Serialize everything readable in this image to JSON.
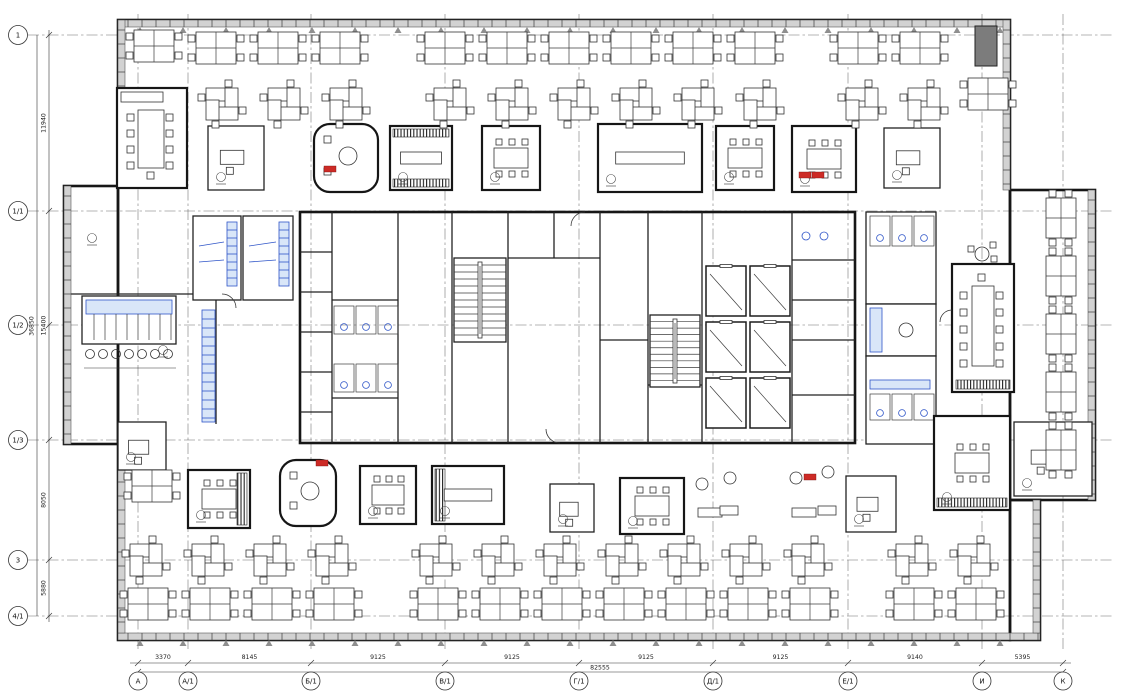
{
  "colors": {
    "line": "#1d1d1d",
    "wall": "#161616",
    "window_fill": "#d2d2d2",
    "grid": "#6a6a6a",
    "accent_blue": "#2f55c8",
    "accent_blue_fill": "#d9e6f8",
    "accent_red": "#cd2b26",
    "shaft_gray": "#7c7c7c",
    "paper": "#ffffff"
  },
  "plan": {
    "axes": {
      "left": [
        {
          "label": "1",
          "y": 35
        },
        {
          "label": "1/1",
          "y": 211
        },
        {
          "label": "1/2",
          "y": 325
        },
        {
          "label": "1/3",
          "y": 440
        },
        {
          "label": "3",
          "y": 560
        },
        {
          "label": "4/1",
          "y": 616
        }
      ],
      "bottom": [
        {
          "label": "А",
          "x": 138
        },
        {
          "label": "А/1",
          "x": 188
        },
        {
          "label": "Б/1",
          "x": 311
        },
        {
          "label": "В/1",
          "x": 445
        },
        {
          "label": "Г/1",
          "x": 579
        },
        {
          "label": "Д/1",
          "x": 713
        },
        {
          "label": "Е/1",
          "x": 848
        },
        {
          "label": "И",
          "x": 982
        },
        {
          "label": "К",
          "x": 1063
        }
      ]
    },
    "dims": {
      "bottom": {
        "segments": [
          {
            "value": "3370"
          },
          {
            "value": "8145"
          },
          {
            "value": "9125"
          },
          {
            "value": "9125"
          },
          {
            "value": "9125"
          },
          {
            "value": "9125"
          },
          {
            "value": "9140"
          },
          {
            "value": "5395"
          }
        ],
        "overall": "82555"
      },
      "left": {
        "segments": [
          {
            "value": "11940",
            "a": 0,
            "b": 1
          },
          {
            "value": "15400",
            "a": 1,
            "b": 3
          },
          {
            "value": "8050",
            "a": 3,
            "b": 4
          },
          {
            "value": "5880",
            "a": 4,
            "b": 5
          }
        ],
        "overall": "36850"
      }
    },
    "outlines": [
      {
        "x": 118,
        "y": 20,
        "w": 892,
        "h": 620
      },
      {
        "x": 1010,
        "y": 190,
        "w": 85,
        "h": 310
      },
      {
        "x": 64,
        "y": 186,
        "w": 54,
        "h": 258
      },
      {
        "x": 1010,
        "y": 500,
        "w": 30,
        "h": 140
      }
    ],
    "inner_walls": [
      [
        64,
        294,
        216,
        294
      ],
      [
        216,
        294,
        216,
        424
      ]
    ],
    "windows": [
      {
        "x": 118,
        "y": 20,
        "w": 892,
        "h": 7,
        "dir": "h"
      },
      {
        "x": 118,
        "y": 633,
        "w": 922,
        "h": 7,
        "dir": "h"
      },
      {
        "x": 64,
        "y": 186,
        "w": 7,
        "h": 258,
        "dir": "v"
      },
      {
        "x": 118,
        "y": 20,
        "w": 7,
        "h": 68,
        "dir": "v"
      },
      {
        "x": 118,
        "y": 444,
        "w": 7,
        "h": 189,
        "dir": "v"
      },
      {
        "x": 1003,
        "y": 20,
        "w": 7,
        "h": 170,
        "dir": "v"
      },
      {
        "x": 1088,
        "y": 190,
        "w": 7,
        "h": 310,
        "dir": "v"
      },
      {
        "x": 1033,
        "y": 500,
        "w": 7,
        "h": 133,
        "dir": "v"
      }
    ],
    "core": {
      "x": 300,
      "y": 212,
      "w": 555,
      "h": 231,
      "vwalls": [
        332,
        398,
        452,
        508,
        600,
        648,
        702,
        792
      ],
      "vwalls_part": [
        [
          554,
          212,
          258
        ]
      ],
      "hwalls": [
        [
          508,
          600,
          258
        ],
        [
          332,
          398,
          300
        ],
        [
          332,
          398,
          398
        ],
        [
          600,
          648,
          340
        ],
        [
          648,
          702,
          385
        ],
        [
          792,
          855,
          260
        ],
        [
          300,
          332,
          252
        ],
        [
          300,
          332,
          292
        ],
        [
          300,
          332,
          332
        ],
        [
          300,
          332,
          372
        ],
        [
          300,
          332,
          412
        ],
        [
          792,
          855,
          300
        ],
        [
          792,
          855,
          340
        ],
        [
          792,
          855,
          395
        ]
      ],
      "stairs": [
        {
          "x": 454,
          "y": 258,
          "w": 52,
          "h": 84,
          "n": 11
        },
        {
          "x": 650,
          "y": 315,
          "w": 50,
          "h": 72,
          "n": 10
        }
      ],
      "elevators": [
        [
          706,
          266
        ],
        [
          750,
          266
        ],
        [
          706,
          322
        ],
        [
          750,
          322
        ],
        [
          706,
          378
        ],
        [
          750,
          378
        ]
      ],
      "stalls": [
        [
          334,
          306
        ],
        [
          356,
          306
        ],
        [
          378,
          306
        ],
        [
          334,
          364
        ],
        [
          356,
          364
        ],
        [
          378,
          364
        ]
      ],
      "wc_circles": [
        [
          806,
          236
        ],
        [
          824,
          236
        ]
      ]
    },
    "east": {
      "wc_top": {
        "x": 866,
        "y": 212,
        "w": 70,
        "h": 92
      },
      "kitchenette": {
        "x": 866,
        "y": 304,
        "w": 70,
        "h": 52
      },
      "wc_bot": {
        "x": 866,
        "y": 356,
        "w": 70,
        "h": 88
      },
      "stalls_top": [
        [
          870,
          216
        ],
        [
          892,
          216
        ],
        [
          914,
          216
        ]
      ],
      "stalls_bot": [
        [
          870,
          394
        ],
        [
          892,
          394
        ],
        [
          914,
          394
        ]
      ],
      "counter": {
        "x": 870,
        "y": 380,
        "w": 60,
        "h": 9
      },
      "counter2": {
        "x": 870,
        "y": 308,
        "w": 12,
        "h": 44
      },
      "basin": [
        906,
        330
      ]
    },
    "left_zone": {
      "kitchen": {
        "x": 82,
        "y": 296,
        "w": 94,
        "h": 48
      },
      "stools": [
        [
          90,
          354
        ],
        [
          103,
          354
        ],
        [
          116,
          354
        ],
        [
          129,
          354
        ],
        [
          142,
          354
        ],
        [
          155,
          354
        ],
        [
          168,
          354
        ]
      ],
      "lockers": {
        "x": 202,
        "y": 310,
        "w": 13,
        "h": 112
      },
      "it_rooms": [
        {
          "x": 193,
          "y": 216,
          "w": 48,
          "h": 84,
          "rack": {
            "x": 227,
            "y": 222,
            "w": 10,
            "h": 64
          }
        },
        {
          "x": 243,
          "y": 216,
          "w": 50,
          "h": 84,
          "rack": {
            "x": 279,
            "y": 222,
            "w": 10,
            "h": 64
          }
        }
      ],
      "conf": {
        "x": 117,
        "y": 88,
        "w": 70,
        "h": 100
      }
    },
    "right_zone": {
      "conf": {
        "x": 952,
        "y": 264,
        "w": 62,
        "h": 128
      },
      "round_table": [
        982,
        254
      ],
      "shaft": {
        "x": 975,
        "y": 26,
        "w": 22,
        "h": 40
      }
    },
    "rooms": [
      {
        "kind": "office",
        "x": 208,
        "y": 126,
        "w": 56,
        "h": 64
      },
      {
        "kind": "pod",
        "x": 314,
        "y": 124,
        "w": 64,
        "h": 68
      },
      {
        "kind": "booth",
        "x": 390,
        "y": 126,
        "w": 62,
        "h": 64,
        "hatch": "tb"
      },
      {
        "kind": "meeting",
        "x": 482,
        "y": 126,
        "w": 58,
        "h": 64
      },
      {
        "kind": "booth",
        "x": 598,
        "y": 124,
        "w": 104,
        "h": 68,
        "hatch": "none"
      },
      {
        "kind": "meeting",
        "x": 716,
        "y": 126,
        "w": 58,
        "h": 64
      },
      {
        "kind": "meeting",
        "x": 792,
        "y": 126,
        "w": 64,
        "h": 66
      },
      {
        "kind": "office",
        "x": 884,
        "y": 128,
        "w": 56,
        "h": 60
      },
      {
        "kind": "pod",
        "x": 280,
        "y": 460,
        "w": 56,
        "h": 66
      },
      {
        "kind": "meeting",
        "x": 360,
        "y": 466,
        "w": 56,
        "h": 58
      },
      {
        "kind": "booth",
        "x": 432,
        "y": 466,
        "w": 72,
        "h": 58,
        "hatch": "left"
      },
      {
        "kind": "office",
        "x": 550,
        "y": 484,
        "w": 44,
        "h": 48
      },
      {
        "kind": "meeting",
        "x": 620,
        "y": 478,
        "w": 64,
        "h": 56
      },
      {
        "kind": "lounge",
        "x": 690,
        "y": 468,
        "w": 56,
        "h": 56
      },
      {
        "kind": "lounge",
        "x": 784,
        "y": 462,
        "w": 60,
        "h": 62
      },
      {
        "kind": "office",
        "x": 846,
        "y": 476,
        "w": 50,
        "h": 56
      },
      {
        "kind": "meeting",
        "x": 934,
        "y": 416,
        "w": 76,
        "h": 94,
        "hatch": "bottom"
      },
      {
        "kind": "office",
        "x": 1014,
        "y": 422,
        "w": 78,
        "h": 74
      },
      {
        "kind": "office",
        "x": 118,
        "y": 422,
        "w": 48,
        "h": 48
      },
      {
        "kind": "meeting",
        "x": 188,
        "y": 470,
        "w": 62,
        "h": 58,
        "hatch": "right"
      }
    ],
    "desks": {
      "quad": [
        [
          196,
          32
        ],
        [
          258,
          32
        ],
        [
          320,
          32
        ],
        [
          425,
          32
        ],
        [
          487,
          32
        ],
        [
          549,
          32
        ],
        [
          611,
          32
        ],
        [
          673,
          32
        ],
        [
          735,
          32
        ],
        [
          838,
          32
        ],
        [
          900,
          32
        ],
        [
          134,
          30
        ],
        [
          968,
          78
        ],
        [
          128,
          588
        ],
        [
          190,
          588
        ],
        [
          252,
          588
        ],
        [
          314,
          588
        ],
        [
          418,
          588
        ],
        [
          480,
          588
        ],
        [
          542,
          588
        ],
        [
          604,
          588
        ],
        [
          666,
          588
        ],
        [
          728,
          588
        ],
        [
          790,
          588
        ],
        [
          894,
          588
        ],
        [
          956,
          588
        ],
        [
          132,
          470
        ]
      ],
      "pin": [
        [
          222,
          104
        ],
        [
          284,
          104
        ],
        [
          346,
          104
        ],
        [
          450,
          104
        ],
        [
          512,
          104
        ],
        [
          574,
          104
        ],
        [
          636,
          104
        ],
        [
          698,
          104
        ],
        [
          760,
          104
        ],
        [
          862,
          104
        ],
        [
          924,
          104
        ],
        [
          146,
          560
        ],
        [
          208,
          560
        ],
        [
          270,
          560
        ],
        [
          332,
          560
        ],
        [
          436,
          560
        ],
        [
          498,
          560
        ],
        [
          560,
          560
        ],
        [
          622,
          560
        ],
        [
          684,
          560
        ],
        [
          746,
          560
        ],
        [
          808,
          560
        ],
        [
          912,
          560
        ],
        [
          974,
          560
        ]
      ],
      "vpair": [
        [
          1046,
          198
        ],
        [
          1046,
          256
        ],
        [
          1046,
          314
        ],
        [
          1046,
          372
        ],
        [
          1046,
          430
        ]
      ]
    },
    "red_items": [
      [
        324,
        166
      ],
      [
        799,
        172
      ],
      [
        812,
        172
      ],
      [
        804,
        474
      ],
      [
        316,
        460
      ]
    ],
    "tags": [
      [
        92,
        238
      ],
      [
        163,
        350
      ]
    ],
    "doors": [
      "M222 294a14 14 0 0 1 14 14",
      "M585 212a14 14 0 0 0 -14 14",
      "M560 443a14 14 0 0 1 -14 -14",
      "M952 310a12 12 0 0 0 -12 12"
    ]
  }
}
